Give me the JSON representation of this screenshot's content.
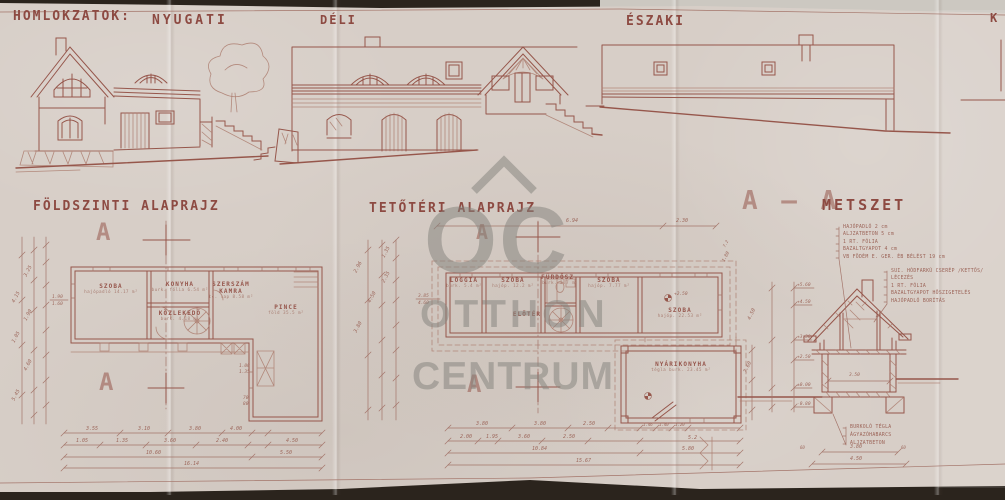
{
  "colors": {
    "paper": "#d7cec7",
    "ink": "#96564b",
    "ink_light": "#ab7c6f",
    "watermark": "#85847e",
    "backdrop": "#2b241d"
  },
  "header": {
    "title": "HOMLOKZATOK:",
    "west": "NYUGATI",
    "south": "DÉLI",
    "north": "ÉSZAKI",
    "east_partial": "K"
  },
  "watermark": {
    "logo_text": "OC",
    "line1": "OTTHON",
    "line2": "CENTRUM"
  },
  "ground_plan": {
    "title": "FÖLDSZINTI ALAPRAJZ",
    "section_letter": "A",
    "rooms": [
      {
        "name": "SZOBA",
        "line2": "",
        "detail": "hajópadló 14.17 m²",
        "x": 111,
        "y": 283
      },
      {
        "name": "KONYHA",
        "line2": "",
        "detail": "burk. fólia 6.54 m²",
        "x": 180,
        "y": 281
      },
      {
        "name": "SZERSZÁM",
        "line2": "KAMRA",
        "detail": "tc. lap 8.58 m²",
        "x": 231,
        "y": 281
      },
      {
        "name": "KÖZLEKEDŐ",
        "line2": "",
        "detail": "burk. 4.18 m²",
        "x": 180,
        "y": 310
      },
      {
        "name": "PINCE",
        "line2": "",
        "detail": "föld 35.5 m²",
        "x": 286,
        "y": 304
      }
    ],
    "dims": [
      {
        "t": "3.55",
        "x": 86,
        "y": 426
      },
      {
        "t": "3.10",
        "x": 138,
        "y": 426
      },
      {
        "t": "3.80",
        "x": 189,
        "y": 426
      },
      {
        "t": "4.00",
        "x": 230,
        "y": 426
      },
      {
        "t": "1.05",
        "x": 76,
        "y": 438
      },
      {
        "t": "1.35",
        "x": 116,
        "y": 438
      },
      {
        "t": "3.60",
        "x": 164,
        "y": 438
      },
      {
        "t": "2.40",
        "x": 216,
        "y": 438
      },
      {
        "t": "4.50",
        "x": 286,
        "y": 438
      },
      {
        "t": "10.60",
        "x": 146,
        "y": 450
      },
      {
        "t": "5.50",
        "x": 280,
        "y": 450
      },
      {
        "t": "16.14",
        "x": 184,
        "y": 461
      },
      {
        "t": "3.25",
        "x": 28,
        "y": 272,
        "r": -62
      },
      {
        "t": "4.15",
        "x": 16,
        "y": 298,
        "r": -62
      },
      {
        "t": "1.90",
        "x": 28,
        "y": 316,
        "r": -62
      },
      {
        "t": "1.05",
        "x": 16,
        "y": 338,
        "r": -62
      },
      {
        "t": "4.60",
        "x": 28,
        "y": 366,
        "r": -62
      },
      {
        "t": "5.45",
        "x": 16,
        "y": 396,
        "r": -62
      },
      {
        "t": "1.90",
        "x": 52,
        "y": 295,
        "s": 4.5
      },
      {
        "t": "1.60",
        "x": 52,
        "y": 302,
        "s": 4.5
      },
      {
        "t": "1.00",
        "x": 239,
        "y": 364,
        "s": 4.5
      },
      {
        "t": "1.35",
        "x": 239,
        "y": 370,
        "s": 4.5
      },
      {
        "t": "70",
        "x": 243,
        "y": 396,
        "s": 4.5
      },
      {
        "t": "80",
        "x": 243,
        "y": 402,
        "s": 4.5
      }
    ]
  },
  "attic_plan": {
    "title": "TETŐTÉRI ALAPRAJZ",
    "section_letter": "A",
    "rooms": [
      {
        "name": "LOGGIA",
        "line2": "",
        "detail": "burk. 5.4 m²",
        "x": 464,
        "y": 277
      },
      {
        "name": "SZOBA",
        "line2": "",
        "detail": "hajóp. 12.2 m²",
        "x": 513,
        "y": 277
      },
      {
        "name": "FÜRDŐSZ.",
        "line2": "",
        "detail": "burk. 3.7 m²",
        "x": 560,
        "y": 274
      },
      {
        "name": "SZOBA",
        "line2": "",
        "detail": "hajóp. 7.77 m²",
        "x": 609,
        "y": 277
      },
      {
        "name": "ELŐTÉR",
        "line2": "",
        "detail": "",
        "x": 527,
        "y": 311
      },
      {
        "name": "SZOBA",
        "line2": "",
        "detail": "hajóp. 22.53 m²",
        "x": 680,
        "y": 307
      },
      {
        "name": "NYÁRIKONYHA",
        "line2": "",
        "detail": "tégla burk. 23.45 m²",
        "x": 681,
        "y": 361
      }
    ],
    "dims": [
      {
        "t": "6.94",
        "x": 566,
        "y": 218
      },
      {
        "t": "2.30",
        "x": 676,
        "y": 218
      },
      {
        "t": "3.80",
        "x": 476,
        "y": 421
      },
      {
        "t": "3.80",
        "x": 534,
        "y": 421
      },
      {
        "t": "2.50",
        "x": 583,
        "y": 421
      },
      {
        "t": "1.46",
        "x": 643,
        "y": 422,
        "s": 4
      },
      {
        "t": "1.40",
        "x": 659,
        "y": 422,
        "s": 4
      },
      {
        "t": "1.20",
        "x": 675,
        "y": 422,
        "s": 4
      },
      {
        "t": "2.00",
        "x": 460,
        "y": 434
      },
      {
        "t": "1.95",
        "x": 486,
        "y": 434
      },
      {
        "t": "3.60",
        "x": 518,
        "y": 434
      },
      {
        "t": "2.50",
        "x": 563,
        "y": 434
      },
      {
        "t": "5.2",
        "x": 688,
        "y": 435
      },
      {
        "t": "10.84",
        "x": 532,
        "y": 446
      },
      {
        "t": "5.80",
        "x": 682,
        "y": 446
      },
      {
        "t": "15.67",
        "x": 576,
        "y": 458
      },
      {
        "t": "2.96",
        "x": 358,
        "y": 268,
        "r": -62
      },
      {
        "t": "2.35",
        "x": 386,
        "y": 278,
        "r": -62
      },
      {
        "t": "4.50",
        "x": 372,
        "y": 298,
        "r": -62
      },
      {
        "t": "3.80",
        "x": 358,
        "y": 328,
        "r": -62
      },
      {
        "t": "1.35",
        "x": 386,
        "y": 253,
        "r": -62
      },
      {
        "t": "3.85",
        "x": 418,
        "y": 294,
        "s": 4.5
      },
      {
        "t": "4.60",
        "x": 418,
        "y": 301,
        "s": 4.5
      },
      {
        "t": "+2.50",
        "x": 674,
        "y": 292,
        "s": 4.5
      },
      {
        "t": "1.80",
        "x": 726,
        "y": 258,
        "r": -62,
        "s": 4.5
      },
      {
        "t": "7.2",
        "x": 726,
        "y": 243,
        "r": -62,
        "s": 4
      }
    ]
  },
  "section_view": {
    "mark": "A – A",
    "title": "METSZET",
    "floor_notes": [
      "HAJÓPADLÓ 2 cm",
      "ALJZATBETON 5 cm",
      "1 RT. FÓLIA",
      "BAZALTGYAPOT 4 cm",
      "VB FÖDÉM E. GER. ÉB BÉLÉST 19 cm"
    ],
    "roof_notes": [
      "SUI. HÓDFARKÚ CSERÉP /KETTŐS/",
      "LÉCEZÉS",
      "1 RT. FÓLIA",
      "BAZALTGYAPOT HŐSZIGETELÉS",
      "HAJÓPADLÓ BORÍTÁS"
    ],
    "base_notes": [
      "BURKOLÓ TÉGLA",
      "ÁGYAZÓHABARCS",
      "ALJZATBETON"
    ],
    "levels": [
      {
        "t": "+5.60",
        "x": 797,
        "y": 283
      },
      {
        "t": "+4.50",
        "x": 797,
        "y": 300
      },
      {
        "t": "+3.30",
        "x": 797,
        "y": 335
      },
      {
        "t": "+2.50",
        "x": 797,
        "y": 355
      },
      {
        "t": "±0.00",
        "x": 797,
        "y": 383
      },
      {
        "t": "-0.80",
        "x": 797,
        "y": 402
      }
    ],
    "dims": [
      {
        "t": "3.50",
        "x": 849,
        "y": 373,
        "s": 4.5
      },
      {
        "t": "3.80",
        "x": 850,
        "y": 444
      },
      {
        "t": "4.50",
        "x": 850,
        "y": 456
      },
      {
        "t": "60",
        "x": 800,
        "y": 445,
        "s": 4
      },
      {
        "t": "60",
        "x": 901,
        "y": 445,
        "s": 4
      },
      {
        "t": "4.50",
        "x": 752,
        "y": 315,
        "r": -65
      },
      {
        "t": "7.60",
        "x": 748,
        "y": 368,
        "r": -65
      }
    ]
  }
}
